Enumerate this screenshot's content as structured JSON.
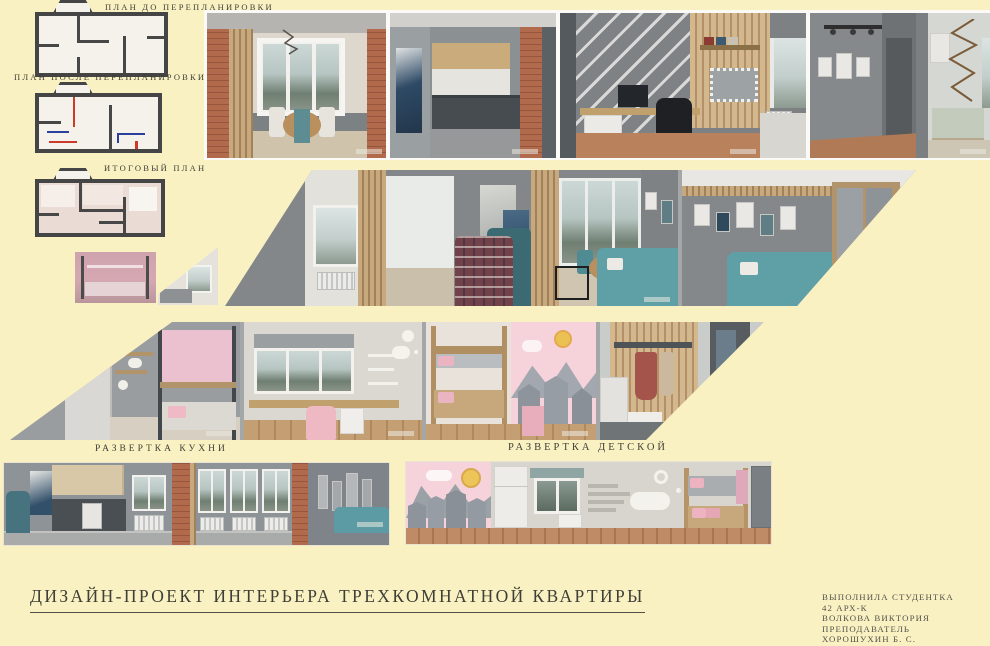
{
  "palette": {
    "background": "#FAF1C2",
    "teal_sofa": "#5F9FA6",
    "brick": "#B26A4D",
    "wall_grey": "#84888B",
    "wood": "#C8A97E",
    "pink": "#F6D2DB",
    "text": "#3E3F37",
    "plan_red": "#CC3B2A",
    "plan_blue": "#2B3F9C"
  },
  "plans": {
    "before_label": "ПЛАН ДО ПЕРЕПЛАНИРОВКИ",
    "after_label": "ПЛАН ПОСЛЕ ПЕРЕПЛАНИРОВКИ",
    "final_label": "ИТОГОВЫЙ ПЛАН"
  },
  "elevations": {
    "kitchen_label": "РАЗВЕРТКА КУХНИ",
    "children_label": "РАЗВЕРТКА ДЕТСКОЙ"
  },
  "title": "ДИЗАЙН-ПРОЕКТ ИНТЕРЬЕРА ТРЕХКОМНАТНОЙ КВАРТИРЫ",
  "credits": {
    "lines": [
      "ВЫПОЛНИЛА СТУДЕНТКА",
      "42 АРХ-К",
      "ВОЛКОВА ВИКТОРИЯ",
      "ПРЕПОДАВАТЕЛЬ",
      "ХОРОШУХИН Б. С."
    ]
  }
}
